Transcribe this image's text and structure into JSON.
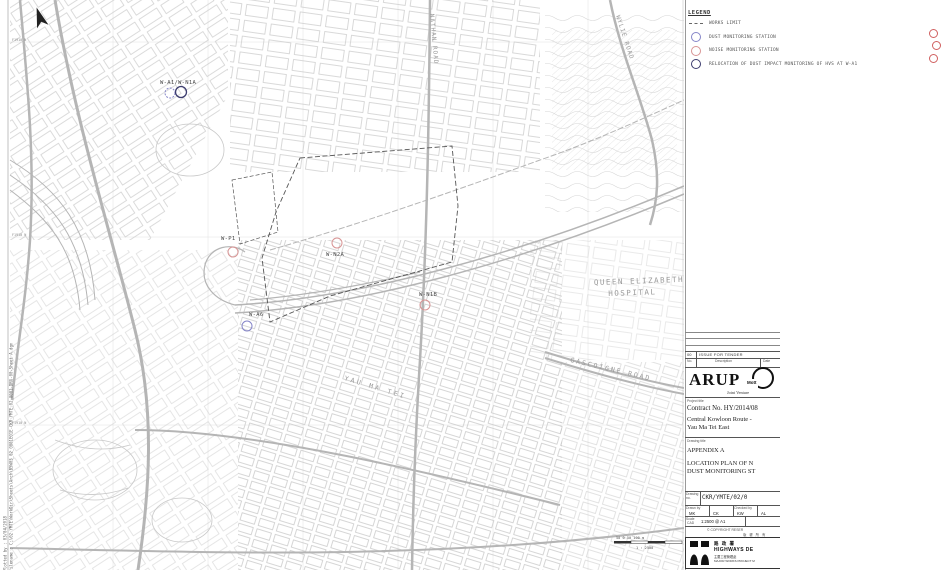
{
  "legend": {
    "title": "LEGEND",
    "items": [
      {
        "symbol": "dashed-line",
        "label": "WORKS LIMIT"
      },
      {
        "symbol": "circle-dust",
        "color": "#8585c8",
        "label": "DUST MONITORING STATION"
      },
      {
        "symbol": "circle-noise",
        "color": "#d89494",
        "label": "NOISE MONITORING STATION"
      },
      {
        "symbol": "circle-relocation",
        "color": "#3c3c6e",
        "label": "RELOCATION OF DUST IMPACT MONITORING OF HVS AT W-A1"
      }
    ]
  },
  "map": {
    "marker_colors": {
      "dust": "#8585c8",
      "noise": "#d89494",
      "relocation": "#3c3c6e"
    },
    "stations": [
      {
        "label": "W-A1/W-N1A",
        "label_x": 160,
        "label_y": 84,
        "markers": [
          {
            "type": "dust",
            "x": 170,
            "y": 93,
            "r": 5,
            "dashed": true
          },
          {
            "type": "relocation",
            "x": 181,
            "y": 92,
            "r": 5.5
          }
        ]
      },
      {
        "label": "W-P1",
        "label_x": 221,
        "label_y": 240,
        "markers": [
          {
            "type": "noise",
            "x": 233,
            "y": 252,
            "r": 5
          }
        ]
      },
      {
        "label": "W-N2A",
        "label_x": 326,
        "label_y": 256,
        "markers": [
          {
            "type": "noise",
            "x": 337,
            "y": 243,
            "r": 5
          }
        ]
      },
      {
        "label": "W-N1B",
        "label_x": 419,
        "label_y": 296,
        "markers": [
          {
            "type": "noise",
            "x": 425,
            "y": 305,
            "r": 5
          }
        ]
      },
      {
        "label": "W-A6",
        "label_x": 249,
        "label_y": 316,
        "markers": [
          {
            "type": "dust",
            "x": 247,
            "y": 326,
            "r": 5
          }
        ]
      }
    ],
    "place_labels": [
      {
        "lines": [
          "NATHAN ROAD"
        ],
        "x": 430,
        "y": 14,
        "rotate": 85,
        "size": 6,
        "spacing": 1
      },
      {
        "lines": [
          "WYLIE ROAD"
        ],
        "x": 616,
        "y": 16,
        "rotate": 72,
        "size": 6,
        "spacing": 1
      },
      {
        "lines": [
          "QUEEN ELIZABETH",
          "HOSPITAL"
        ],
        "x": 594,
        "y": 285,
        "rotate": -2,
        "size": 7.5,
        "spacing": 1.5
      },
      {
        "lines": [
          "GASCOIGNE ROAD"
        ],
        "x": 570,
        "y": 362,
        "rotate": 13,
        "size": 6.5,
        "spacing": 2
      },
      {
        "lines": [
          "YAU MA TEI"
        ],
        "x": 344,
        "y": 380,
        "rotate": 17,
        "size": 6.5,
        "spacing": 2.5
      }
    ],
    "grid_labels": [
      {
        "text": "F1910 N",
        "x": 12,
        "y": 41
      },
      {
        "text": "F1910 N",
        "x": 12,
        "y": 236
      },
      {
        "text": "F1910 N",
        "x": 12,
        "y": 424
      }
    ],
    "scale_bar": {
      "ticks_label": "50  0  50  100 m",
      "scale_label": "1 : 2500"
    }
  },
  "plot_info": {
    "line1": "Plotted by : 03/04/2018",
    "line2": "Filename : C:\\02 YMTE\\WorkDir\\Sheets\\Arch\\B5W03_02_0001E01E-CKR_YMTE_02_0001-DRG-00-Sheet A.dgn"
  },
  "review_marks_color": "#d06060",
  "title_block": {
    "revision": {
      "rev": "00",
      "description": "ISSUE FOR TENDER"
    },
    "table_headers": {
      "rev": "No.",
      "description": "Description",
      "date": "Date"
    },
    "joint_venture": {
      "arup": "ARUP",
      "partner": "Mott",
      "label": "Joint Venture"
    },
    "project": {
      "label": "Project title",
      "contract": "Contract No. HY/2014/08",
      "name_line1": "Central Kowloon Route -",
      "name_line2": "Yau Ma Tei East"
    },
    "drawing": {
      "label": "Drawing title",
      "appendix": "APPENDIX A",
      "title_line1": "LOCATION PLAN OF N",
      "title_line2": "DUST MONITORING ST"
    },
    "drawing_no": {
      "label": "Drawing no.",
      "value": "CKR/YMTE/02/0"
    },
    "drawn": {
      "label": "Drawn by",
      "v1": "MK",
      "v2": "CK"
    },
    "checked": {
      "label": "Checked by",
      "v1": "KW",
      "v2": "AL"
    },
    "scale": {
      "label": "Scale",
      "sub": "CAD",
      "value": "1:2500 @ A1"
    },
    "copyright": "© COPYRIGHT RESER",
    "copyright_cjk": "版 權 所 有",
    "department": {
      "chinese": "路 政 署",
      "english": "HIGHWAYS DE",
      "sub_chinese": "主要工程管理處",
      "sub_english": "MAJOR WORKS PROJECT M"
    }
  }
}
